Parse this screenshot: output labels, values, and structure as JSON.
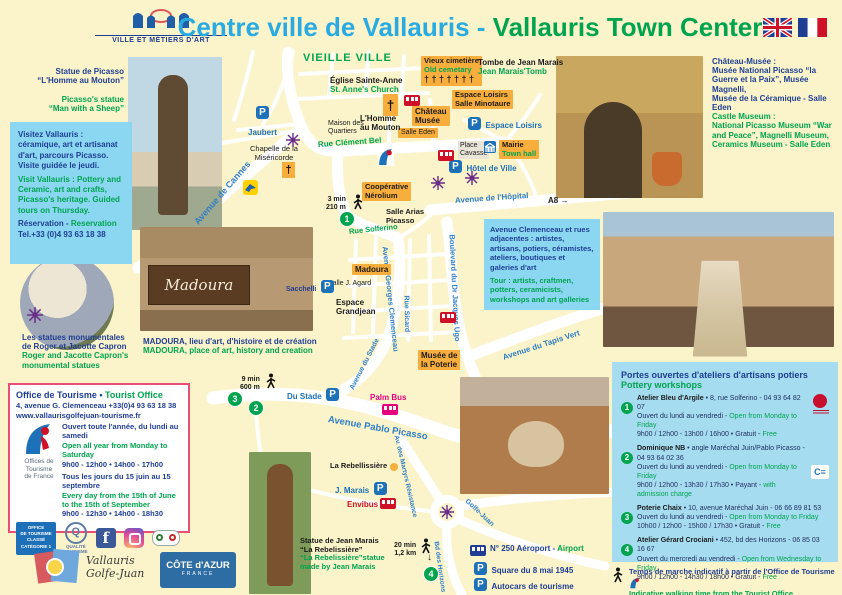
{
  "colors": {
    "title_cyan": "#29ABE2",
    "green": "#00A44F",
    "navy": "#1F3E93",
    "orange_label": "#F8AE3C",
    "info_box_blue": "#8BD7F2",
    "workshop_box_blue": "#A6DCF0",
    "parking_blue": "#1D71B8",
    "bus_red": "#CE1126",
    "palm_bus_pink": "#E6007E"
  },
  "header": {
    "logo_caption": "VILLE ET MÉTIERS D'ART",
    "title_fr": "Centre ville de Vallauris - ",
    "title_en": "Vallauris Town Center"
  },
  "left": {
    "picasso_fr": "Statue de Picasso\n“L'Homme au Mouton”",
    "picasso_en": "Picasso's statue\n“Man with a Sheep”",
    "visit_fr": "Visitez Vallauris : céramique, art et artisanat d'art, parcours Picasso. Visite guidée le jeudi.",
    "visit_en": "Visit Vallauris : Pottery and Ceramic, art and crafts, Picasso's heritage. Guided tours on Thursday.",
    "reservation_fr": "Réservation - ",
    "reservation_en": "Reservation",
    "reservation_tel": "Tel.+33 (0)4 93 63 18 38",
    "capron_fr": "Les statues monumentales\nde Roger et Jacotte Capron",
    "capron_en": "Roger and Jacotte Capron's\nmonumental statues"
  },
  "office": {
    "title_fr": "Office de Tourisme • ",
    "title_en": "Tourist Office",
    "address": "4, avenue G. Clemenceau  +33(0)4 93 63 18 38",
    "website": "www.vallaurisgolfejuan-tourisme.fr",
    "logo_text": "Offices de\nTourisme\nde France",
    "open1_fr": "Ouvert toute l'année, du lundi au samedi",
    "open1_en": "Open all year from Monday to Saturday",
    "open1_hours": "9h00 - 12h00 • 14h00 - 17h00",
    "open2_fr": "Tous les jours du 15 juin au 15 septembre",
    "open2_en": "Every day from the 15th of June to the 15th of September",
    "open2_hours": "9h00 - 12h30 • 14h00 - 18h30",
    "badge_text": "OFFICE\nDE TOURISME\nCLASSÉ\nCATÉGORIE 1",
    "quality_text": "QUALITÉ\nTOURISME"
  },
  "footer_logos": {
    "vallauris_script": "Vallauris\nGolfe-Juan",
    "cote_azur": "CÔTE d'AZUR",
    "cote_azur_sub": "FRANCE"
  },
  "chateau": {
    "fr": "Château-Musée :\nMusée National Picasso “la Guerre et la Paix”, Musée Magnelli,\nMusée de la Céramique - Salle Eden",
    "en": "Castle Museum :\nNational Picasso Museum “War and Peace”, Magnelli Museum,\nCeramics Museum - Salle Eden"
  },
  "clemenceau_box": {
    "fr": "Avenue Clemenceau et rues adjacentes : artistes, artisans, potiers, céramistes, ateliers, boutiques et galeries d'art",
    "en": "Tour : artists, craftmen, potters, ceramicists, workshops and art galleries"
  },
  "workshops": {
    "title_fr": "Portes ouvertes d'ateliers d'artisans potiers",
    "title_en": "Pottery workshops",
    "items": [
      {
        "num": "1",
        "name": "Atelier Bleu d'Argile",
        "detail": " • 8, rue Solferino - 04 93 64 82 07",
        "open_fr": "Ouvert du lundi au vendredi - ",
        "open_en": "Open from Monday to Friday",
        "hours_fr": "9h00 / 12h00 - 13h00 / 16h00 • Gratuit - ",
        "hours_en": "Free"
      },
      {
        "num": "2",
        "name": "Dominique NB",
        "detail": " • angle Maréchal Juin/Pablo Picasso - 04 93 64 02 36",
        "open_fr": "Ouvert du lundi au vendredi - ",
        "open_en": "Open from Monday to Friday",
        "hours_fr": "9h00 / 12h00 - 13h30 / 17h30 • Payant - ",
        "hours_en": "with admission charge"
      },
      {
        "num": "3",
        "name": "Poterie Chaix",
        "detail": " • 10, avenue Maréchal Juin - 06 66 89 81 53",
        "open_fr": "Ouvert du lundi au vendredi - ",
        "open_en": "Open from Monday to Friday",
        "hours_fr": "10h00 / 12h00 - 15h00 / 17h30 • Gratuit - ",
        "hours_en": "Free"
      },
      {
        "num": "4",
        "name": "Atelier Gérard Crociani",
        "detail": " • 452, bd des Horizons - 06 85 03 16 67",
        "open_fr": "Ouvert du mercredi au vendredi - ",
        "open_en": "Open from Wednesday to Friday",
        "hours_fr": "9h00 / 12h00 - 14h30 / 18h00 • Gratuit - ",
        "hours_en": "Free"
      }
    ]
  },
  "walk_note": {
    "fr": "Temps de marche indicatif à partir de l'Office de Tourisme",
    "en": "Indicative walking time from the Tourist Office"
  },
  "map": {
    "vieille_ville": "VIEILLE VILLE",
    "eglise_fr": "Église Sainte-Anne",
    "eglise_en": "St. Anne's Church",
    "cimetiere_fr": "Vieux cimetière",
    "cimetiere_en": "Old cemetary",
    "cimetiere_crosses": "† † † † † † †",
    "tombe_fr": "Tombe de Jean Marais",
    "tombe_en": "Jean Marais'Tomb",
    "espace_loisirs_box": "Espace Loisirs\nSalle Minotaure",
    "p_espace_loisirs": "Espace Loisirs",
    "chateau_musee": "Château\nMusée",
    "salle_eden": "Salle Eden",
    "homme_mouton": "L'Homme\nau Mouton",
    "maison_quartiers": "Maison des\nQuartiers",
    "jaubert": "Jaubert",
    "chapelle": "Chapelle de la\nMiséricorde",
    "cooperative": "Coopérative\nNérolium",
    "walk1": "3 min\n210 m",
    "marker1": "1",
    "salle_arias": "Salle Arias\nPicasso",
    "a8": "A8 →",
    "place_cavasse": "Place\nCavasse",
    "mairie_fr": "Mairie",
    "mairie_en": "Town hall",
    "hotel_ville": "Hôtel de Ville",
    "madoura": "Madoura",
    "salle_agard": "Salle J. Agard",
    "sacchelli": "Sacchelli",
    "espace_grandjean": "Espace\nGrandjean",
    "musee_poterie": "Musée de\nla Poterie",
    "madoura_caption_fr": "MADOURA, lieu d'art, d'histoire et de création",
    "madoura_caption_en": "MADOURA, place of art, history and creation",
    "walk2": "9 min\n600 m",
    "marker2": "2",
    "marker3": "3",
    "du_stade": "Du Stade",
    "palm_bus": "Palm Bus",
    "rebellissiere": "La Rebellissière",
    "j_marais": "J. Marais",
    "envibus": "Envibus",
    "walk4": "20 min\n1,2 km",
    "marker4": "4",
    "statue_jm_fr": "Statue de Jean Marais\n“La Rebelissière”",
    "statue_jm_en": "“La Rebelissière”statue\nmade by Jean Marais",
    "aeroport_fr": "N° 250 Aéroport - ",
    "aeroport_en": "Airport",
    "square_mai": "Square du 8 mai 1945",
    "autocars_fr": "Autocars de tourisme",
    "autocars_en": "Coach parking",
    "streets": {
      "avenue_cannes": "Avenue de Cannes",
      "rue_clement_bel": "Rue Clément Bel",
      "rue_solferino": "Rue Solferino",
      "av_g_clemenceau": "Avenue Georges Clemenceau",
      "bd_jacques_ugo": "Boulevard du Dr Jacques Ugo",
      "rue_sicard": "Rue Sicard",
      "av_stade": "Avenue du Stade",
      "av_tapis_vert": "Avenue du Tapis Vert",
      "av_hopital": "Avenue de l'Hôpital",
      "av_pablo_picasso": "Avenue Pablo Picasso",
      "av_martyrs": "Av. des Martyrs Résistance",
      "bd_horizons": "Bd des Horizons",
      "golfe_juan": "Golfe-Juan"
    }
  },
  "photos": {
    "madoura_sign": "Madoura"
  }
}
